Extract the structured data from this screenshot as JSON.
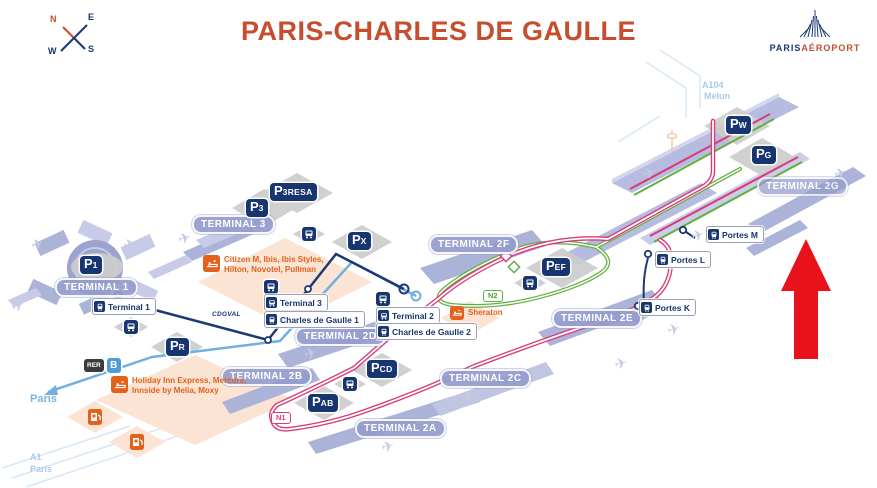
{
  "header": {
    "title": "PARIS-CHARLES DE GAULLE",
    "logo": {
      "word1": "PARIS",
      "word2": "AÉROPORT"
    },
    "compass": {
      "n": "N",
      "e": "E",
      "w": "W",
      "s": "S"
    }
  },
  "map": {
    "terminals": [
      {
        "label": "TERMINAL 1"
      },
      {
        "label": "TERMINAL 3"
      },
      {
        "label": "TERMINAL 2B"
      },
      {
        "label": "TERMINAL 2D"
      },
      {
        "label": "TERMINAL 2A"
      },
      {
        "label": "TERMINAL 2C"
      },
      {
        "label": "TERMINAL 2E"
      },
      {
        "label": "TERMINAL 2F"
      },
      {
        "label": "TERMINAL 2G"
      }
    ],
    "parkings": [
      {
        "main": "P",
        "sub": "1"
      },
      {
        "main": "P",
        "sub": "3"
      },
      {
        "main": "P",
        "sub": "3RESA"
      },
      {
        "main": "P",
        "sub": "X"
      },
      {
        "main": "P",
        "sub": "R"
      },
      {
        "main": "P",
        "sub": "AB"
      },
      {
        "main": "P",
        "sub": "CD"
      },
      {
        "main": "P",
        "sub": "EF"
      },
      {
        "main": "P",
        "sub": "W"
      },
      {
        "main": "P",
        "sub": "G"
      }
    ],
    "stations": [
      {
        "label": "Terminal 1",
        "type": "train"
      },
      {
        "label": "Terminal 3",
        "type": "bus"
      },
      {
        "label": "Charles de Gaulle 1",
        "type": "train"
      },
      {
        "label": "Terminal 2",
        "type": "bus"
      },
      {
        "label": "Charles de Gaulle 2",
        "type": "train"
      },
      {
        "label": "Portes M",
        "type": "train"
      },
      {
        "label": "Portes L",
        "type": "train"
      },
      {
        "label": "Portes K",
        "type": "train"
      }
    ],
    "rer": {
      "badge": "RER",
      "line": "B"
    },
    "cdgval_label": "CDGVAL",
    "roads": {
      "n1": "N1",
      "n2": "N2",
      "a104": "A104",
      "melun": "Melun",
      "a1": "A1",
      "a1_city": "Paris",
      "rer_city": "Paris"
    },
    "hotels": [
      {
        "line1": "Citizen M,  Ibis, Ibis Styles,",
        "line2": "Hilton, Novotel, Pullman"
      },
      {
        "line1": "Sheraton",
        "line2": ""
      },
      {
        "line1": "Holiday Inn Express, Mercure,",
        "line2": "Innside by Melia, Moxy"
      }
    ],
    "colors": {
      "title_orange": "#C74E2D",
      "navy": "#17356F",
      "terminal_badge": "#949CCD",
      "rer_blue": "#6FB0E2",
      "cdgval_navy": "#1C3876",
      "road_pink": "#D83C78",
      "road_green": "#63AE3F",
      "hotel_orange": "#E2611B",
      "arrow_red": "#E8121B",
      "building_purple": "#ACB3D9"
    }
  }
}
